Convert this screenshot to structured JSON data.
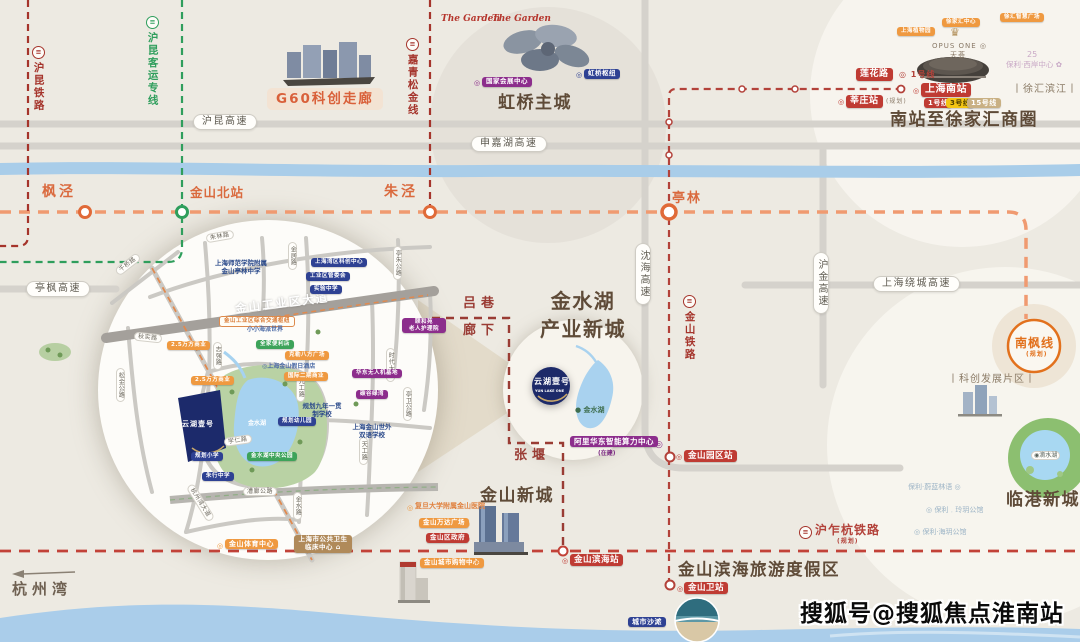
{
  "watermark": "搜狐号@搜狐焦点淮南站",
  "colors": {
    "background": "#edeae2",
    "river": "#a9cde9",
    "road": "#d5d2cc",
    "rail_red": "#a5342b",
    "rail_green": "#2f9e5c",
    "metro_orange": "#f09a70",
    "title_brown": "#5f4b38",
    "badge_orange": "#ef9940",
    "badge_red": "#bf3b33",
    "badge_blue": "#2e4193",
    "badge_purple": "#8c2d8c",
    "project_navy": "#1d2a69",
    "nanfeng_orange": "#e2711d"
  },
  "elements": [
    {
      "n": "hukun-railway-icon",
      "c": "ticon red",
      "t": "≡",
      "x": 32,
      "y": 46
    },
    {
      "n": "hukun-railway-label",
      "c": "vrail red",
      "t": "沪昆铁路",
      "x": 32,
      "y": 62
    },
    {
      "n": "hukun-hsr-icon",
      "c": "ticon green",
      "t": "≡",
      "x": 146,
      "y": 16
    },
    {
      "n": "hukun-hsr-label",
      "c": "vrail green",
      "t": "沪昆客运专线",
      "x": 146,
      "y": 32
    },
    {
      "n": "jiaqingsongjin-icon",
      "c": "ticon red",
      "t": "≡",
      "x": 406,
      "y": 38
    },
    {
      "n": "jiaqingsongjin-label",
      "c": "vrail red",
      "t": "嘉青松金线",
      "x": 406,
      "y": 54
    },
    {
      "n": "g60-corridor-label",
      "c": "g60",
      "t": "G60科创走廊",
      "x": 267,
      "y": 88
    },
    {
      "n": "hukun-expwy-pill",
      "c": "pill",
      "t": "沪昆高速",
      "x": 193,
      "y": 114
    },
    {
      "n": "shenjiahu-expwy-pill",
      "c": "pill",
      "t": "申嘉湖高速",
      "x": 471,
      "y": 136
    },
    {
      "n": "tingfeng-expwy-pill",
      "c": "pill",
      "t": "亭枫高速",
      "x": 26,
      "y": 281
    },
    {
      "n": "station-fengjing-label",
      "c": "station",
      "t": "枫泾",
      "x": 42,
      "y": 184
    },
    {
      "n": "station-jinshanbei-label",
      "c": "station",
      "t": "金山北站",
      "x": 190,
      "y": 185,
      "fs": 12.5,
      "ls": 1
    },
    {
      "n": "station-zhujing-label",
      "c": "station",
      "t": "朱泾",
      "x": 384,
      "y": 184
    },
    {
      "n": "station-tinglin-label",
      "c": "station",
      "t": "亭林",
      "x": 672,
      "y": 191,
      "fs": 13,
      "ls": 2
    },
    {
      "n": "garden-logo-1",
      "c": "logo-red",
      "t": "The Garden",
      "x": 441,
      "y": 14
    },
    {
      "n": "garden-logo-2",
      "c": "logo-red",
      "t": "The Garden",
      "x": 492,
      "y": 14
    },
    {
      "n": "necc-dot",
      "c": "dot dpur",
      "t": "◎",
      "x": 474,
      "y": 79
    },
    {
      "n": "necc-badge",
      "c": "b bpur",
      "t": "国家会展中心",
      "x": 482,
      "y": 77,
      "fs": 6.5
    },
    {
      "n": "hongqiao-hub-dot",
      "c": "dot dblue",
      "t": "◎",
      "x": 576,
      "y": 71
    },
    {
      "n": "hongqiao-hub-badge",
      "c": "b bblue",
      "t": "虹桥枢纽",
      "x": 584,
      "y": 69,
      "fs": 6.5
    },
    {
      "n": "hongqiao-title",
      "c": "title",
      "t": "虹桥主城",
      "x": 498,
      "y": 93
    },
    {
      "n": "xujiahui-center-badge",
      "c": "b bor",
      "t": "徐家汇中心",
      "x": 942,
      "y": 18,
      "fs": 5.5
    },
    {
      "n": "xuhui-plaza-badge",
      "c": "b bor",
      "t": "徐汇智慧广场",
      "x": 1000,
      "y": 13,
      "fs": 5.5
    },
    {
      "n": "botanical-garden-badge",
      "c": "b bor",
      "t": "上海植物园",
      "x": 897,
      "y": 27,
      "fs": 5.5
    },
    {
      "n": "opus-crown-icon",
      "c": "crown",
      "t": "♛",
      "x": 950,
      "y": 26
    },
    {
      "n": "opus-one-label",
      "c": "t-gray",
      "t": "OPUS ONE ◎",
      "x": 932,
      "y": 42,
      "fs": 7
    },
    {
      "n": "tianhui-label",
      "c": "t-gray",
      "t": "天荟",
      "x": 950,
      "y": 51,
      "fs": 7
    },
    {
      "n": "lianhua-rd-badge",
      "c": "b bred",
      "t": "莲花路",
      "x": 856,
      "y": 68,
      "fs": 9
    },
    {
      "n": "line1-transfer-label",
      "c": "t-red",
      "t": "◎ 1号线",
      "x": 899,
      "y": 70,
      "fs": 8
    },
    {
      "n": "xinzhuang-dot",
      "c": "dot dred",
      "t": "◎",
      "x": 838,
      "y": 98
    },
    {
      "n": "xinzhuang-badge",
      "c": "b bred",
      "t": "莘庄站",
      "x": 846,
      "y": 95,
      "fs": 9
    },
    {
      "n": "xinzhuang-note",
      "c": "t-gray",
      "t": "(规划)",
      "x": 886,
      "y": 98,
      "fs": 6
    },
    {
      "n": "shanghai-south-dot",
      "c": "dot dred",
      "t": "◎",
      "x": 913,
      "y": 87
    },
    {
      "n": "shanghai-south-badge",
      "c": "b bred",
      "t": "上海南站",
      "x": 921,
      "y": 83,
      "fs": 10
    },
    {
      "n": "metro-line1-badge",
      "c": "b bred",
      "t": "1号线",
      "x": 924,
      "y": 98,
      "fs": 7
    },
    {
      "n": "metro-line3-badge",
      "c": "b byel",
      "t": "3号线",
      "x": 946,
      "y": 98,
      "fs": 7
    },
    {
      "n": "metro-line15-badge",
      "c": "b btan2",
      "t": "15号线",
      "x": 967,
      "y": 98,
      "fs": 7
    },
    {
      "n": "poly-25-label",
      "c": "t-lav",
      "t": "25",
      "x": 1027,
      "y": 50,
      "fs": 8
    },
    {
      "n": "poly-westbund-label",
      "c": "t-lav",
      "t": "保利·西岸中心 ✿",
      "x": 1006,
      "y": 60,
      "fs": 7.5
    },
    {
      "n": "xuhui-riverside-label",
      "c": "t-brown",
      "t": "丨徐汇滨江丨",
      "x": 1012,
      "y": 84,
      "fs": 10
    },
    {
      "n": "south-station-title",
      "c": "title",
      "t": "南站至徐家汇商圈",
      "x": 890,
      "y": 110
    },
    {
      "n": "luxiang-label",
      "c": "district",
      "t": "吕巷",
      "x": 463,
      "y": 296
    },
    {
      "n": "langxia-label",
      "c": "district",
      "t": "廊下",
      "x": 463,
      "y": 323
    },
    {
      "n": "zhangyan-label",
      "c": "district",
      "t": "张堰",
      "x": 514,
      "y": 448
    },
    {
      "n": "jinshuihu-title",
      "c": "title title-c",
      "t": "金水湖\n产业新城",
      "x": 523,
      "y": 287,
      "w": 120
    },
    {
      "n": "shenhai-expwy-pill",
      "c": "vpill",
      "t": "沈海高速",
      "x": 635,
      "y": 243
    },
    {
      "n": "jinshan-railway-icon",
      "c": "ticon red",
      "t": "≡",
      "x": 683,
      "y": 295
    },
    {
      "n": "jinshan-railway-label",
      "c": "vrail red",
      "t": "金山铁路",
      "x": 683,
      "y": 311
    },
    {
      "n": "hujin-expwy-pill",
      "c": "vpill",
      "t": "沪金高速",
      "x": 813,
      "y": 252
    },
    {
      "n": "raocheng-expwy-pill",
      "c": "pill",
      "t": "上海绕城高速",
      "x": 873,
      "y": 276
    },
    {
      "n": "yunhu-logo-text",
      "c": "t-white",
      "t": "云湖壹号",
      "x": 534,
      "y": 377,
      "fs": 8,
      "ls": 1
    },
    {
      "n": "yunhu-logo-sub",
      "c": "t-white",
      "t": "YUN LAKE ONE",
      "x": 535,
      "y": 389,
      "fs": 3.5
    },
    {
      "n": "jinshui-lake-label",
      "c": "t-lake",
      "t": "● 金水湖",
      "x": 575,
      "y": 406,
      "fs": 7
    },
    {
      "n": "ali-computing-badge",
      "c": "b bpur",
      "t": "阿里华东智能算力中心",
      "x": 570,
      "y": 436,
      "fs": 7.5
    },
    {
      "n": "ali-computing-note",
      "c": "t-pur",
      "t": "(在建)",
      "x": 598,
      "y": 450,
      "fs": 6
    },
    {
      "n": "ali-computing-dot",
      "c": "dot dpur",
      "t": "◎",
      "x": 655,
      "y": 440,
      "fs": 9
    },
    {
      "n": "park-station-dot",
      "c": "dot dred",
      "t": "◎",
      "x": 676,
      "y": 453
    },
    {
      "n": "jinshan-park-station-badge",
      "c": "b bred",
      "t": "金山园区站",
      "x": 684,
      "y": 450,
      "fs": 8.5
    },
    {
      "n": "nanfeng-line-label",
      "c": "t-nf",
      "t": "南枫线",
      "x": 1015,
      "y": 336,
      "fs": 12
    },
    {
      "n": "nanfeng-line-note",
      "c": "t-nf",
      "t": "(规划)",
      "x": 1026,
      "y": 351,
      "fs": 6
    },
    {
      "n": "kechuang-district-label",
      "c": "t-brown",
      "t": "丨科创发展片区丨",
      "x": 948,
      "y": 374,
      "fs": 10
    },
    {
      "n": "dishui-lake-label",
      "c": "pill-xs",
      "t": "◉滴水湖",
      "x": 1031,
      "y": 451
    },
    {
      "n": "poly-project-1",
      "c": "t-lb",
      "t": "保利·蔚蓝林语 ◎",
      "x": 908,
      "y": 483,
      "fs": 7
    },
    {
      "n": "poly-project-2",
      "c": "t-lb",
      "t": "◎ 保利﹒玲玥公馆",
      "x": 926,
      "y": 506,
      "fs": 7
    },
    {
      "n": "poly-project-3",
      "c": "t-lb",
      "t": "◎ 保利·海玥公馆",
      "x": 914,
      "y": 528,
      "fs": 7
    },
    {
      "n": "lingang-title",
      "c": "title",
      "t": "临港新城",
      "x": 1006,
      "y": 490
    },
    {
      "n": "huzhahang-icon",
      "c": "ticon red",
      "t": "≡",
      "x": 799,
      "y": 526
    },
    {
      "n": "huzhahang-label",
      "c": "t-red",
      "t": "沪乍杭铁路",
      "x": 815,
      "y": 523,
      "fs": 12
    },
    {
      "n": "huzhahang-note",
      "c": "t-red",
      "t": "(规划)",
      "x": 837,
      "y": 538,
      "fs": 6
    },
    {
      "n": "binhai-resort-title",
      "c": "title",
      "t": "金山滨海旅游度假区",
      "x": 678,
      "y": 560,
      "fs": 16.5
    },
    {
      "n": "jinshanwei-dot",
      "c": "dot dred",
      "t": "◎",
      "x": 677,
      "y": 585
    },
    {
      "n": "jinshanwei-station-badge",
      "c": "b bred",
      "t": "金山卫站",
      "x": 684,
      "y": 582,
      "fs": 8.5
    },
    {
      "n": "binhai-station-dot",
      "c": "dot dred",
      "t": "◎",
      "x": 562,
      "y": 557
    },
    {
      "n": "binhai-station-badge",
      "c": "b bred",
      "t": "金山滨海站",
      "x": 570,
      "y": 554,
      "fs": 8.5
    },
    {
      "n": "city-beach-badge",
      "c": "b bblue",
      "t": "城市沙滩",
      "x": 628,
      "y": 617,
      "fs": 7
    },
    {
      "n": "city-beach-dot",
      "c": "dot dblue",
      "t": "◎",
      "x": 659,
      "y": 619
    },
    {
      "n": "jinshan-newcity-title",
      "c": "title",
      "t": "金山新城",
      "x": 480,
      "y": 486
    },
    {
      "n": "fudan-hospital-dot",
      "c": "dot dor",
      "t": "◎",
      "x": 407,
      "y": 504
    },
    {
      "n": "fudan-hospital-label",
      "c": "t-or",
      "t": "复旦大学附属金山医院",
      "x": 415,
      "y": 502,
      "fs": 7
    },
    {
      "n": "wanda-plaza-badge",
      "c": "b bor",
      "t": "金山万达广场",
      "x": 419,
      "y": 518,
      "fs": 6.5
    },
    {
      "n": "wanda-plaza-dot",
      "c": "dot dor",
      "t": "◎",
      "x": 464,
      "y": 520
    },
    {
      "n": "district-gov-badge",
      "c": "b bred",
      "t": "金山区政府",
      "x": 426,
      "y": 533,
      "fs": 6.5
    },
    {
      "n": "district-gov-dot",
      "c": "dot dred",
      "t": "◎",
      "x": 464,
      "y": 535
    },
    {
      "n": "city-mall-badge",
      "c": "b bor",
      "t": "金山城市购物中心",
      "x": 420,
      "y": 558,
      "fs": 6.5
    },
    {
      "n": "city-mall-dot",
      "c": "dot dor",
      "t": "◎",
      "x": 474,
      "y": 560
    },
    {
      "n": "sports-center-dot",
      "c": "dot dor",
      "t": "◎",
      "x": 217,
      "y": 542
    },
    {
      "n": "sports-center-badge",
      "c": "b bor",
      "t": "金山体育中心",
      "x": 225,
      "y": 539,
      "fs": 7
    },
    {
      "n": "public-health-badge",
      "c": "b btan",
      "t": "上海市公共卫生\n临床中心 ⌂",
      "x": 294,
      "y": 535,
      "w": 50,
      "fs": 6.5
    },
    {
      "n": "hangzhou-bay-label",
      "c": "hzw",
      "t": "杭州湾",
      "x": 12,
      "y": 580
    },
    {
      "n": "watermark",
      "c": "wm",
      "t": "搜狐号@搜狐焦点淮南站",
      "x": 800,
      "y": 601
    },
    {
      "n": "inset-industrial-ave-label",
      "c": "roadlbl",
      "t": "金山工业区大道",
      "x": 235,
      "y": 297,
      "r": -7
    },
    {
      "n": "inset-road-qianqiao",
      "c": "pill-s",
      "t": "千桥路",
      "x": 114,
      "y": 260,
      "r": -38
    },
    {
      "n": "inset-road-zhulin",
      "c": "pill-s",
      "t": "朱林路",
      "x": 206,
      "y": 232,
      "r": -10
    },
    {
      "n": "inset-road-jinju",
      "c": "vpill-s",
      "t": "金居路",
      "x": 288,
      "y": 242
    },
    {
      "n": "inset-road-tingzhu",
      "c": "vpill-s",
      "t": "亭朱公路",
      "x": 393,
      "y": 246
    },
    {
      "n": "inset-road-songjin",
      "c": "vpill-s",
      "t": "松金公路",
      "x": 116,
      "y": 368
    },
    {
      "n": "inset-road-zhiqiang",
      "c": "vpill-s",
      "t": "志强路",
      "x": 213,
      "y": 342
    },
    {
      "n": "inset-road-qiushi",
      "c": "pill-s",
      "t": "秋实路",
      "x": 134,
      "y": 333,
      "r": 6
    },
    {
      "n": "inset-road-xueren",
      "c": "pill-s",
      "t": "学仁路",
      "x": 224,
      "y": 436,
      "r": -8
    },
    {
      "n": "inset-road-jiugong",
      "c": "vpill-s",
      "t": "九工路",
      "x": 296,
      "y": 374
    },
    {
      "n": "inset-road-tiangong",
      "c": "vpill-s",
      "t": "天工路",
      "x": 359,
      "y": 437
    },
    {
      "n": "inset-road-shidai",
      "c": "vpill-s",
      "t": "时代大道",
      "x": 386,
      "y": 348
    },
    {
      "n": "inset-road-tingwei",
      "c": "vpill-s",
      "t": "亭卫公路",
      "x": 403,
      "y": 387
    },
    {
      "n": "inset-road-jinshui",
      "c": "vpill-s",
      "t": "金水路",
      "x": 293,
      "y": 492
    },
    {
      "n": "inset-road-hangzhouwan",
      "c": "pill-s",
      "t": "杭州湾大道",
      "x": 180,
      "y": 498,
      "r": 58
    },
    {
      "n": "inset-road-caolang",
      "c": "pill-s",
      "t": "漕廊公路",
      "x": 243,
      "y": 487
    },
    {
      "n": "inset-transport-hub-badge",
      "c": "b outline-or",
      "t": "金山工业区综合交通枢纽",
      "x": 219,
      "y": 316,
      "fs": 5.5
    },
    {
      "n": "inset-commercial-1-badge",
      "c": "b bor",
      "t": "2.5万方商业",
      "x": 167,
      "y": 341,
      "fs": 5.5
    },
    {
      "n": "inset-commercial-2-badge",
      "c": "b bor",
      "t": "2.5万方商业",
      "x": 191,
      "y": 376,
      "fs": 5.5
    },
    {
      "n": "inset-bayarea-center-badge",
      "c": "b bblue",
      "t": "上海湾区科创中心",
      "x": 311,
      "y": 258,
      "fs": 5.5
    },
    {
      "n": "inset-admin-badge",
      "c": "b bblue",
      "t": "工业区管委会",
      "x": 306,
      "y": 272,
      "fs": 5.5
    },
    {
      "n": "inset-school-badge",
      "c": "b bblue",
      "t": "实验中学",
      "x": 310,
      "y": 285,
      "fs": 5.5
    },
    {
      "n": "inset-tinglin-school-label",
      "c": "t-navy",
      "t": "上海师范学院附属\n金山亭林中学",
      "x": 206,
      "y": 259,
      "w": 70,
      "fs": 6.5
    },
    {
      "n": "inset-familymart-badge",
      "c": "b bgrn",
      "t": "全家便利店",
      "x": 256,
      "y": 340,
      "fs": 5.5
    },
    {
      "n": "inset-haipai-label",
      "c": "t-blue",
      "t": "小小海派世界",
      "x": 247,
      "y": 326,
      "fs": 6
    },
    {
      "n": "inset-kele-plaza-badge",
      "c": "b bor",
      "t": "克勒八方广场",
      "x": 285,
      "y": 351,
      "fs": 5.5
    },
    {
      "n": "inset-holiday-inn-label",
      "c": "t-blue",
      "t": "◎上海金山假日酒店",
      "x": 262,
      "y": 363,
      "fs": 6
    },
    {
      "n": "inset-phase2-badge",
      "c": "b bor",
      "t": "国际二期商业",
      "x": 284,
      "y": 372,
      "fs": 5.5
    },
    {
      "n": "inset-uav-base-badge",
      "c": "b bpur",
      "t": "华东无人机基地",
      "x": 352,
      "y": 369,
      "fs": 5.5
    },
    {
      "n": "inset-tangu-badge",
      "c": "b bpur",
      "t": "碳谷绿湾",
      "x": 356,
      "y": 390,
      "fs": 5.5
    },
    {
      "n": "inset-nursing-badge",
      "c": "b bpur",
      "t": "颐和苑\n老人护理院",
      "x": 402,
      "y": 318,
      "w": 36,
      "fs": 5.5
    },
    {
      "n": "inset-kindergarten-badge",
      "c": "b bblue",
      "t": "规划幼儿园",
      "x": 278,
      "y": 417,
      "fs": 5.5
    },
    {
      "n": "inset-primary-school-badge",
      "c": "b bblue",
      "t": "规划小学",
      "x": 191,
      "y": 452,
      "fs": 5.5
    },
    {
      "n": "inset-zhuhang-school-badge",
      "c": "b bblue",
      "t": "朱行中学",
      "x": 202,
      "y": 472,
      "fs": 5.5
    },
    {
      "n": "inset-bilingual-school-label",
      "c": "t-navy",
      "t": "上海金山世外\n双语学校",
      "x": 348,
      "y": 423,
      "w": 48,
      "fs": 6.5
    },
    {
      "n": "inset-nine-year-school-label",
      "c": "t-navy",
      "t": "规划九年一贯\n制学校",
      "x": 300,
      "y": 402,
      "w": 44,
      "fs": 6.5
    },
    {
      "n": "inset-lake-park-badge",
      "c": "b bgrn",
      "t": "金水湖中央公园",
      "x": 247,
      "y": 452,
      "fs": 5.5
    },
    {
      "n": "inset-lake-label",
      "c": "t-white",
      "t": "金水湖",
      "x": 248,
      "y": 420,
      "fs": 6
    },
    {
      "n": "inset-project-logo-text",
      "c": "t-white",
      "t": "云湖壹号",
      "x": 182,
      "y": 420,
      "fs": 7,
      "ls": 1
    }
  ]
}
